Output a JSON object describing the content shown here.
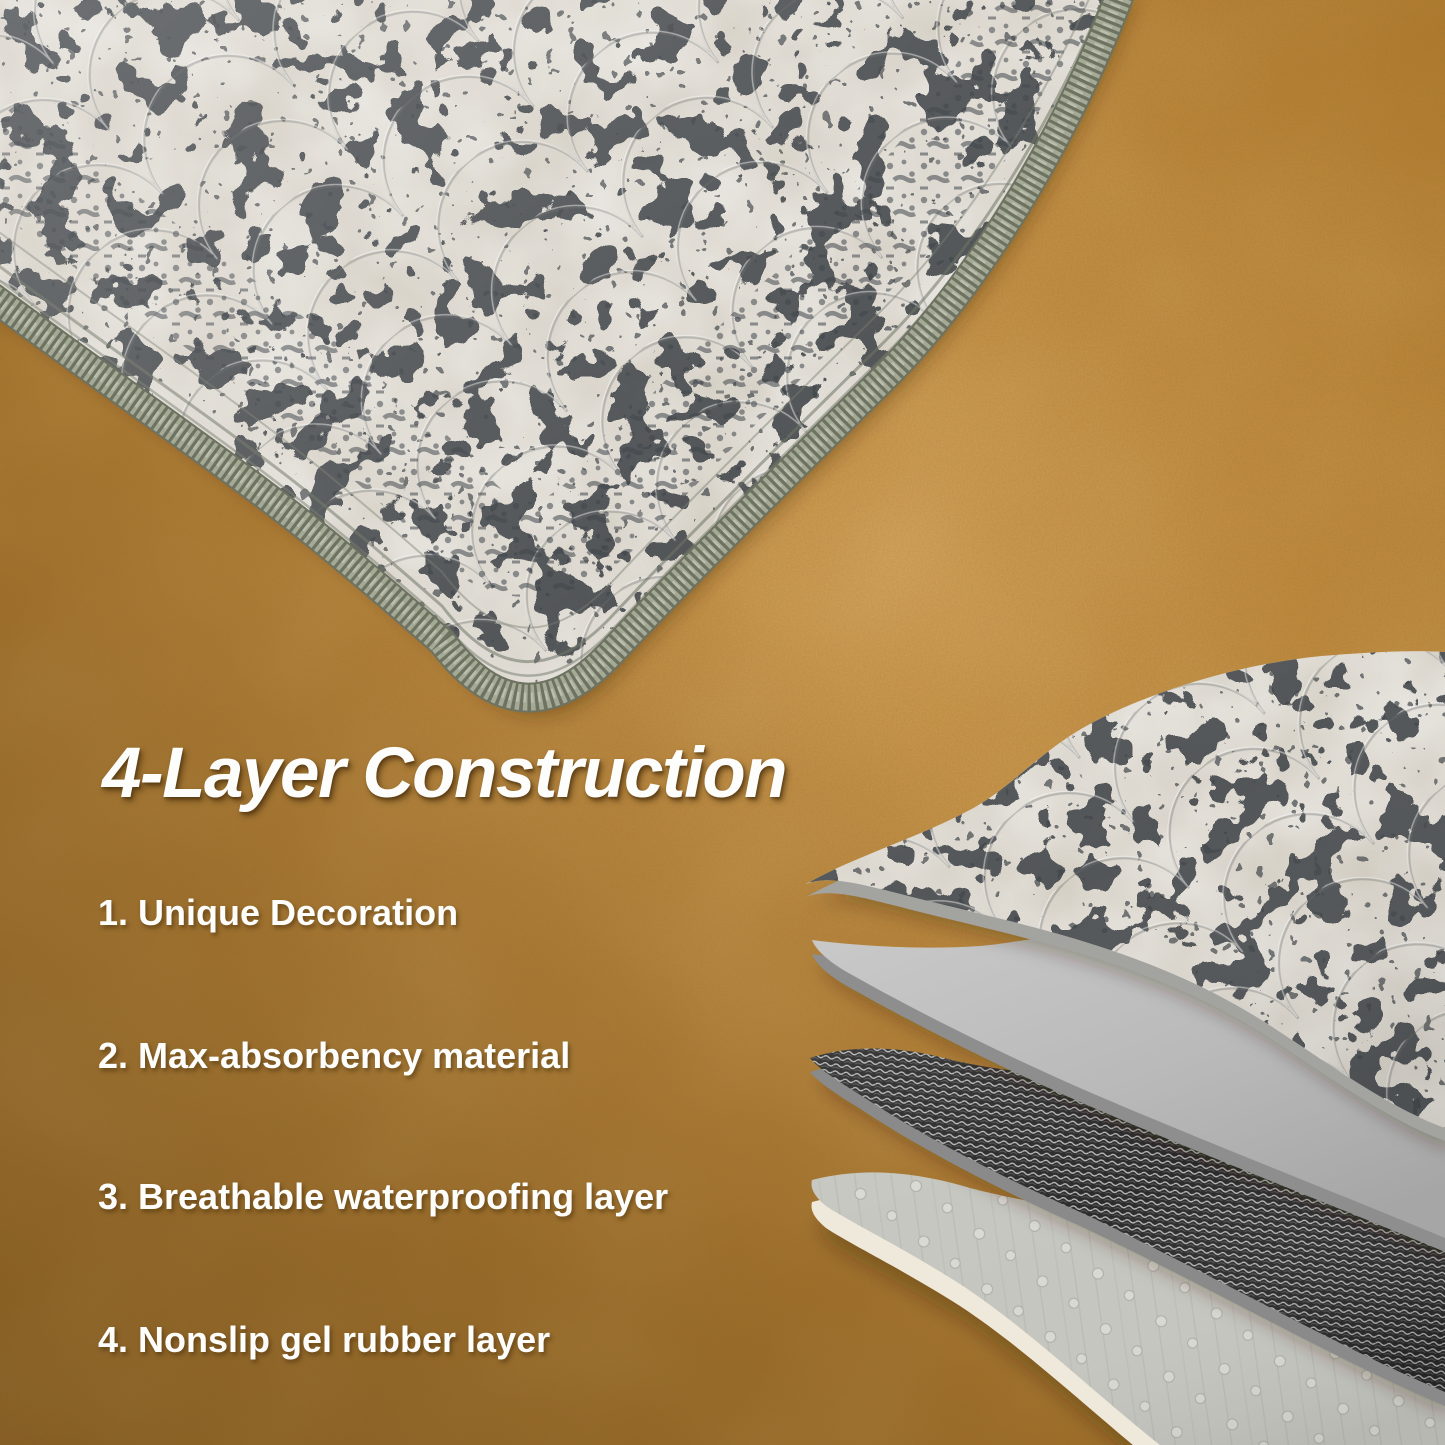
{
  "title": "4-Layer Construction",
  "features": [
    "1. Unique Decoration",
    "2. Max-absorbency material",
    "3. Breathable waterproofing layer",
    "4. Nonslip gel rubber layer"
  ],
  "layer_count": "4",
  "colors": {
    "text": "#fdfdfb",
    "floor": "#ad7628",
    "floor_highlight": "#d9a55b",
    "mat_fabric": "#e9e7e2",
    "print_speckle": "#474b50",
    "edge_trim": "#9aa08c",
    "layer_absorbent": "#bdbdbd",
    "layer_waterproof": "#2b2b2b",
    "layer_nonslip": "#c6c6c0",
    "layer_backing_strip": "#eee9db"
  }
}
